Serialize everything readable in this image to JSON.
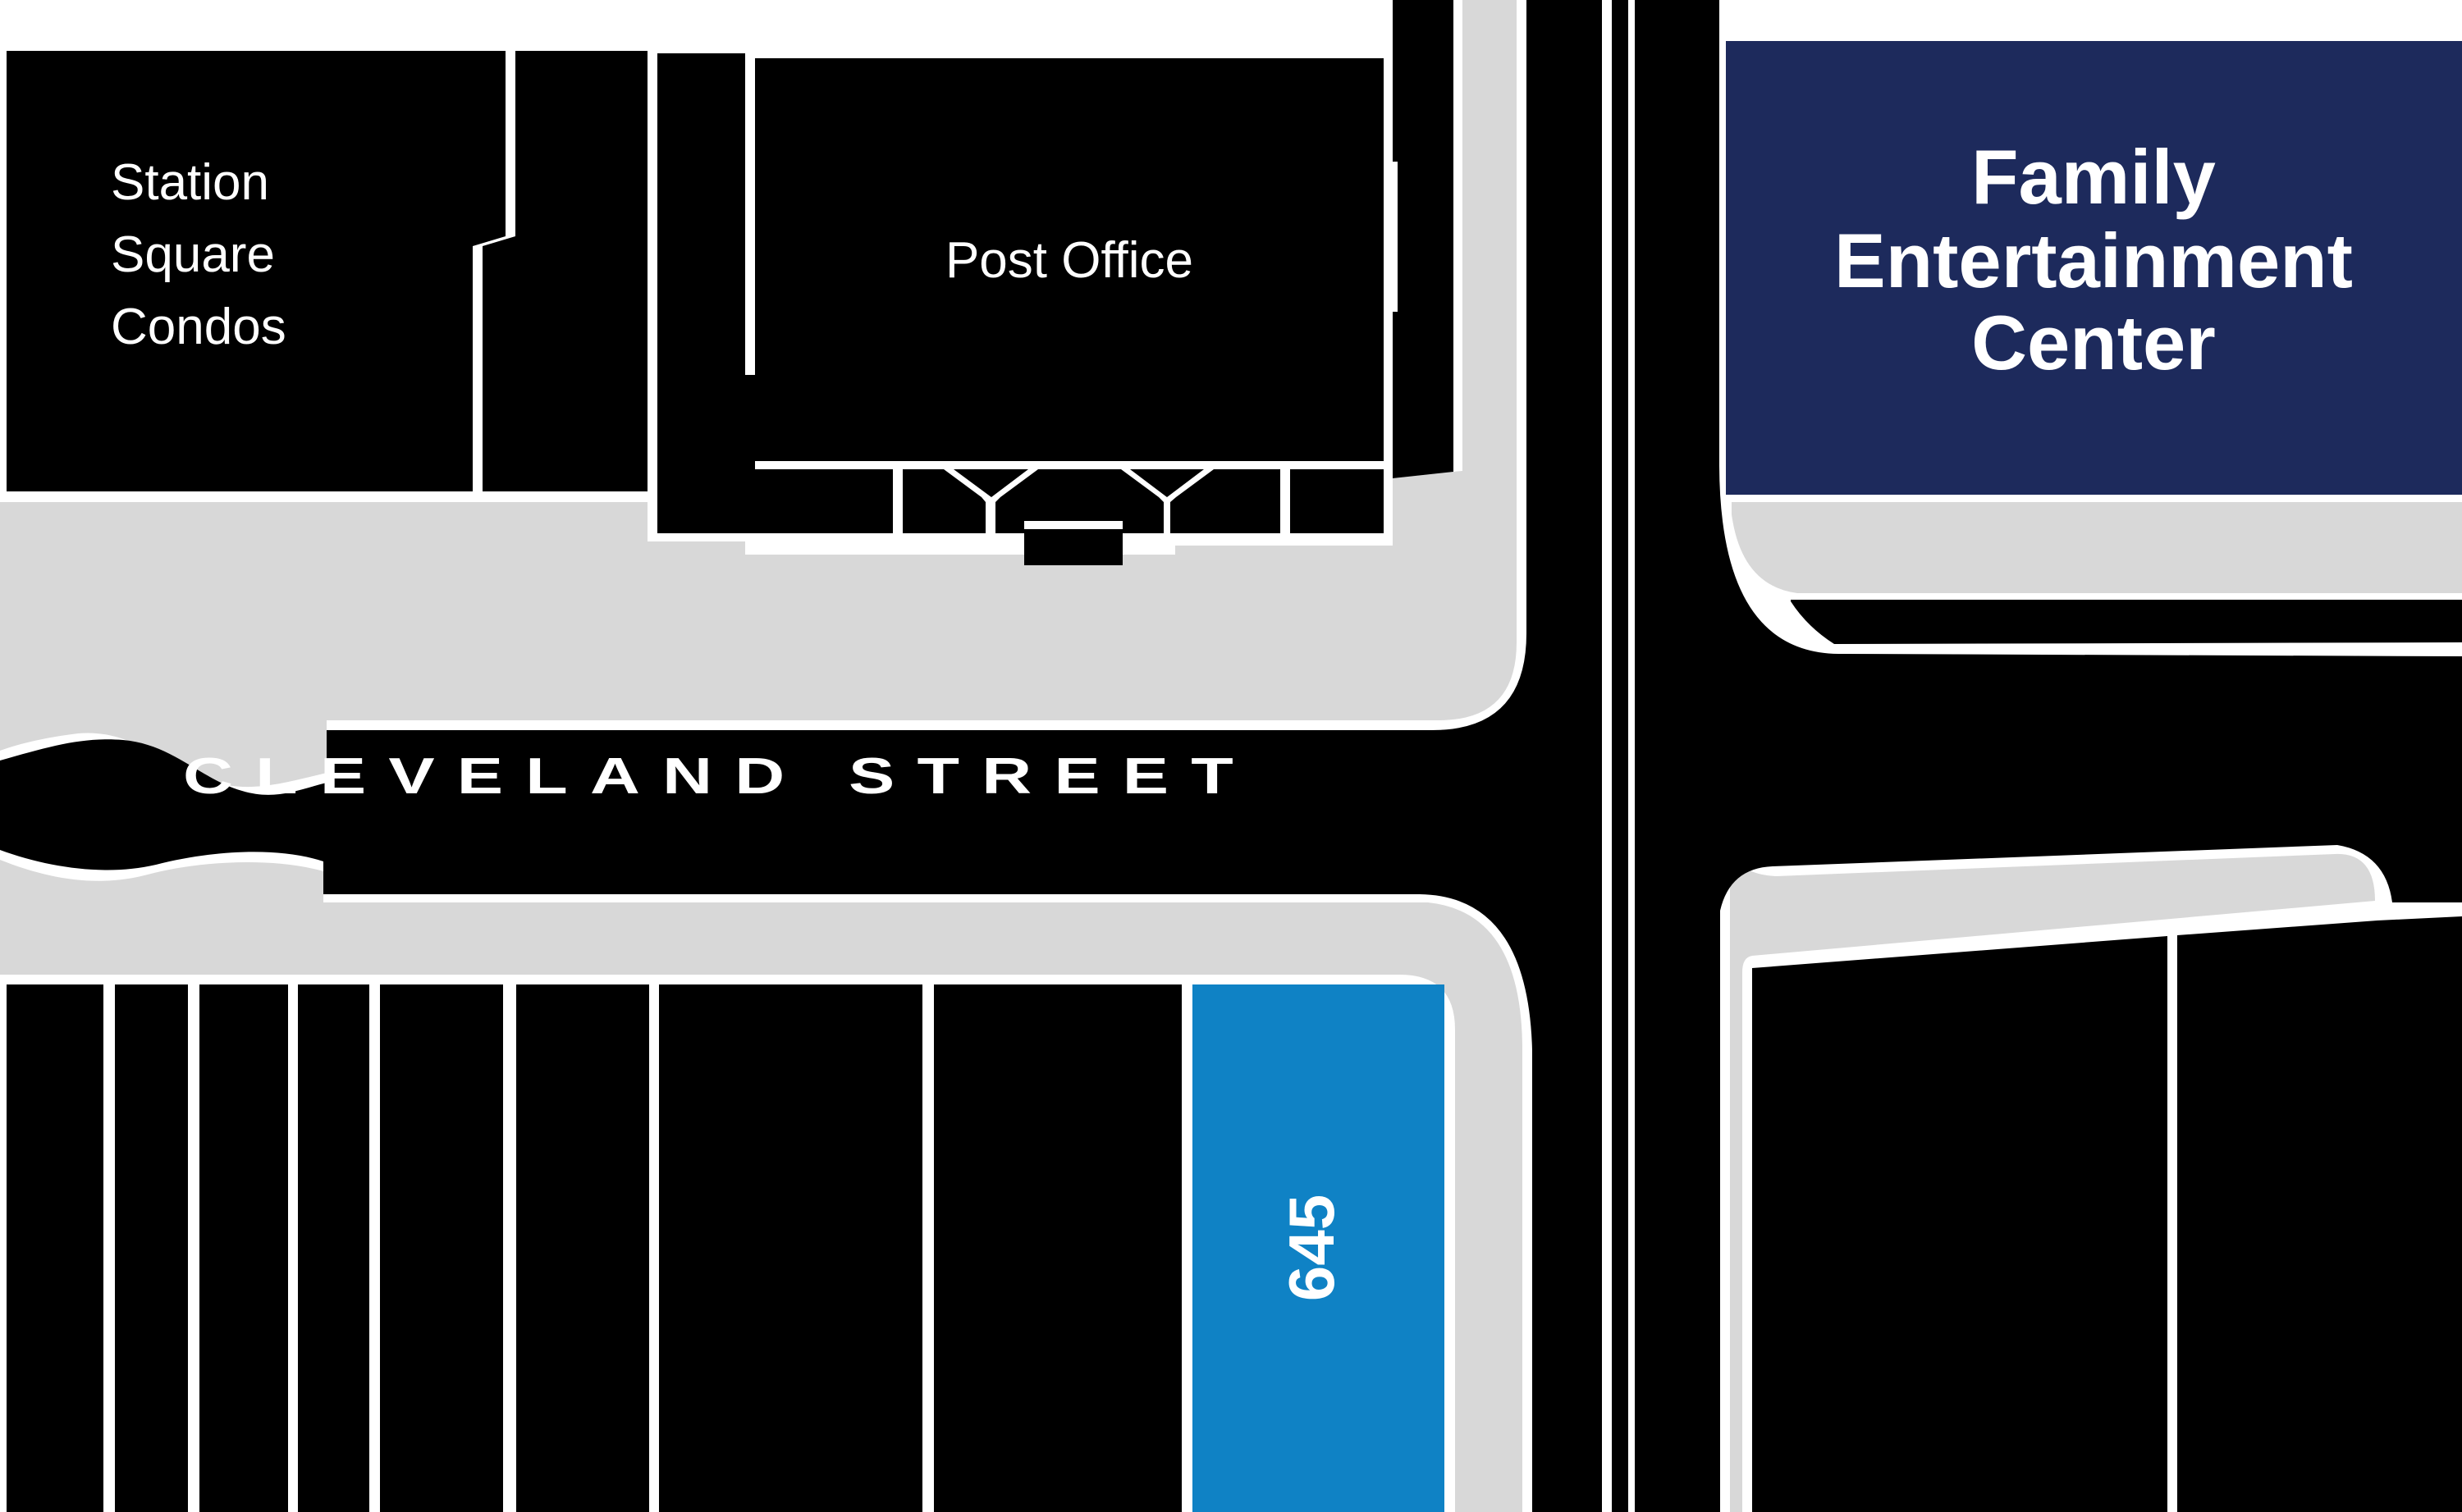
{
  "map": {
    "title": "Neighborhood site map",
    "labels": {
      "station_square_condos": {
        "lines": [
          "Station",
          "Square",
          "Condos"
        ]
      },
      "post_office": {
        "text": "Post Office"
      },
      "family_entertainment_center": {
        "lines": [
          "Family",
          "Entertainment",
          "Center"
        ]
      },
      "cleveland_street": {
        "text": "CLEVELAND STREET"
      },
      "parcel_645": {
        "text": "645"
      }
    },
    "colors": {
      "background": "#ffffff",
      "building_black": "#000000",
      "street_black": "#000000",
      "sidewalk_gray": "#d8d8d8",
      "fec_navy": "#1d2a5c",
      "parcel_blue": "#0f82c5",
      "label_white": "#ffffff"
    }
  }
}
